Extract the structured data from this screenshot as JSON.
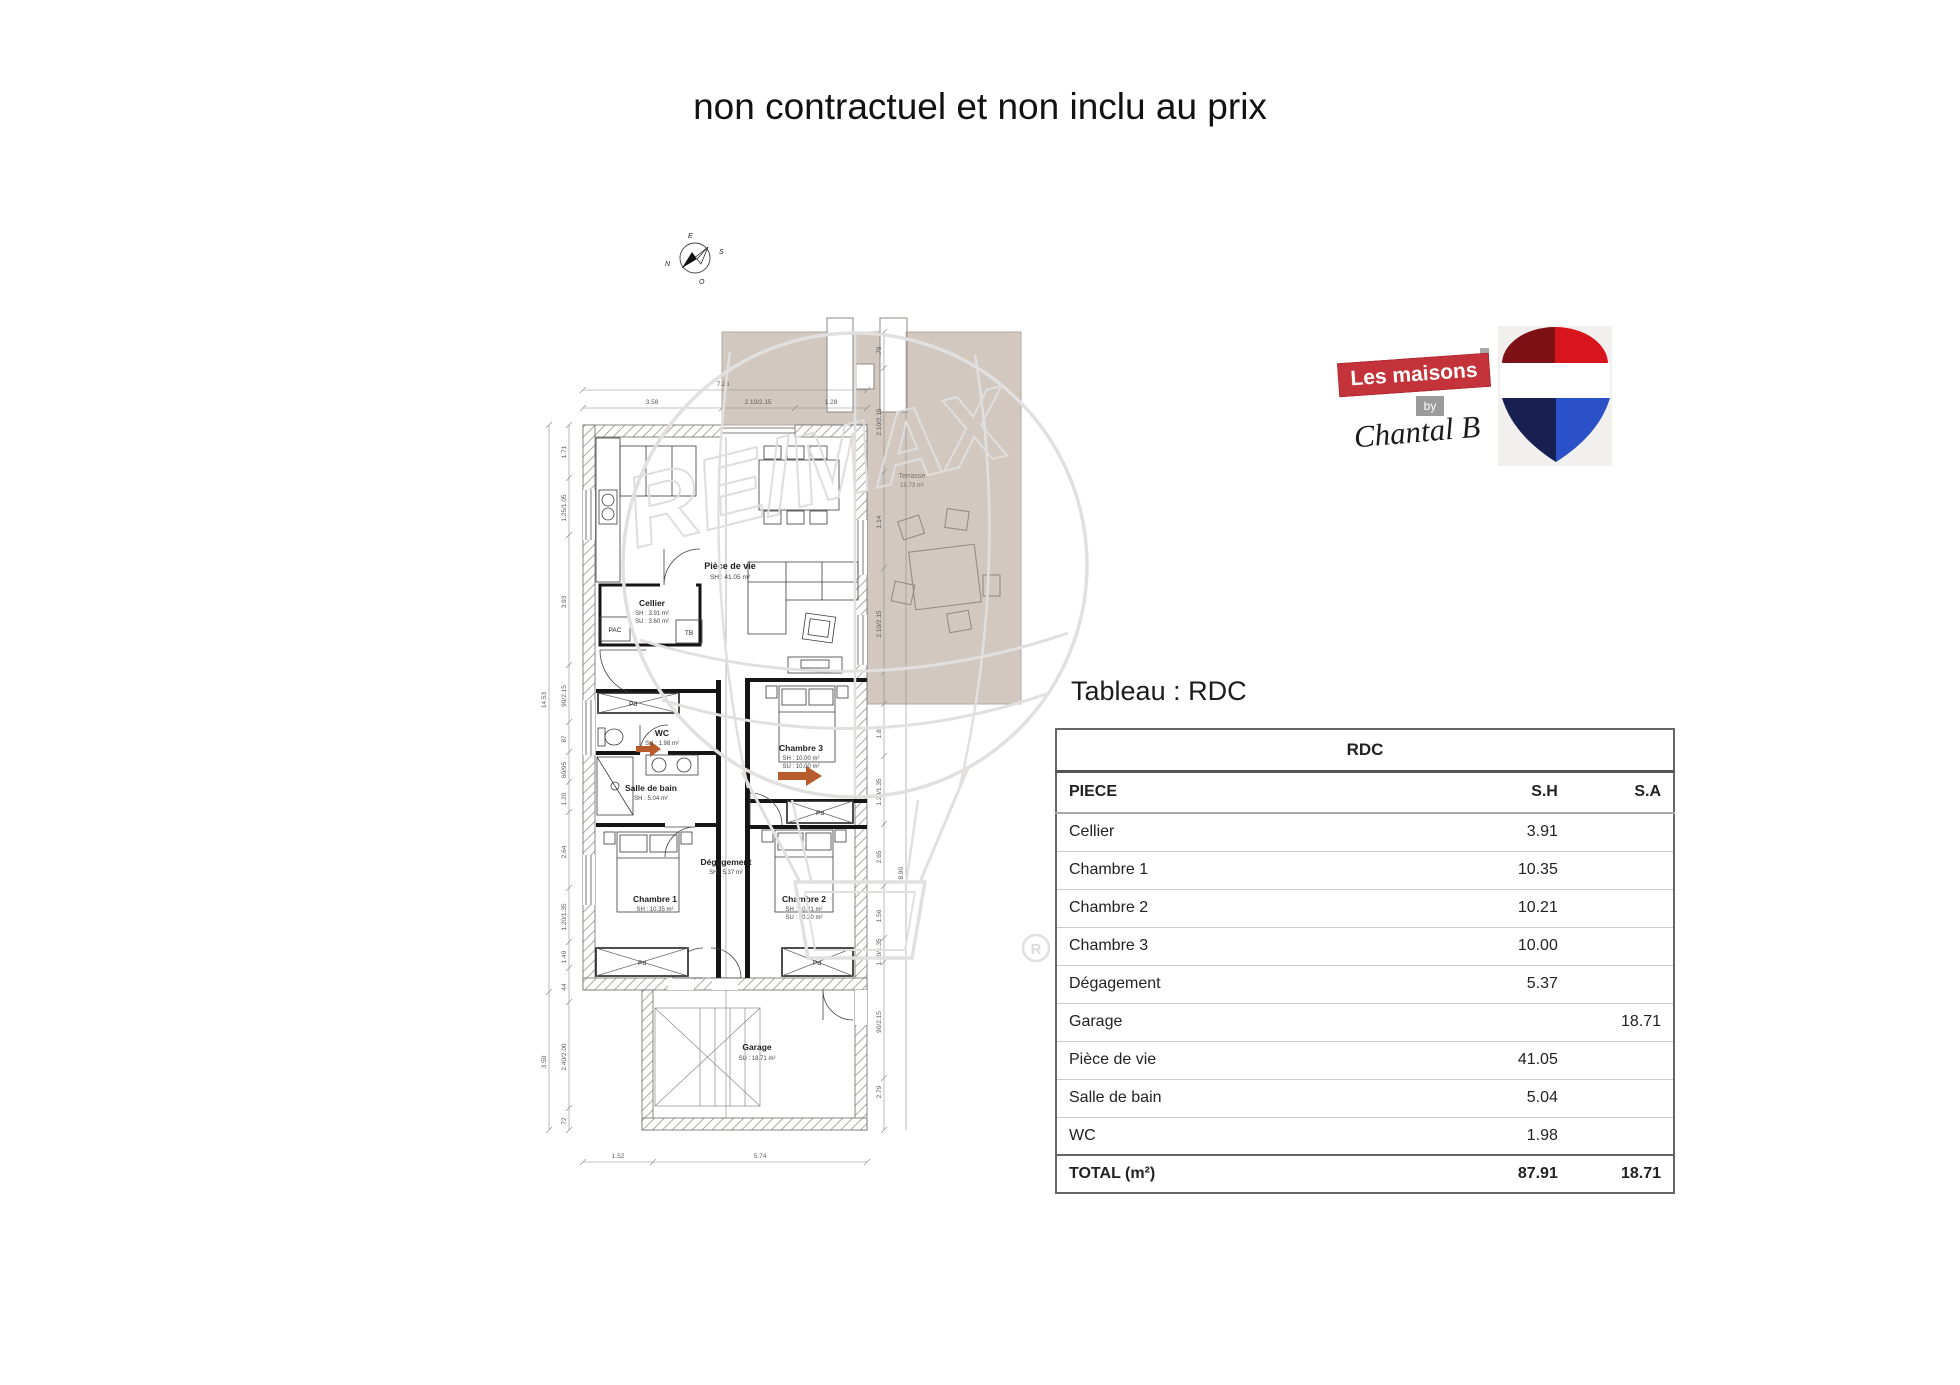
{
  "title": "non contractuel et non inclu au prix",
  "section_title": "Tableau : RDC",
  "watermark": {
    "text": "RE/MAX",
    "registered": "R"
  },
  "brand": {
    "line1": "Les maisons",
    "by": "by",
    "signature": "Chantal B"
  },
  "compass": {
    "top": "E",
    "right": "S",
    "bottom": "O",
    "left": "N"
  },
  "plan": {
    "rooms": {
      "piece_de_vie": {
        "name": "Pièce de vie",
        "sh": "SH : 41.05 m²"
      },
      "cellier": {
        "name": "Cellier",
        "sh": "SH : 3.91 m²",
        "su": "SU : 3.60 m²"
      },
      "wc": {
        "name": "WC",
        "sh": "SH : 1.98 m²"
      },
      "salle_de_bain": {
        "name": "Salle de bain",
        "sh": "SH : 5.04 m²"
      },
      "chambre1": {
        "name": "Chambre 1",
        "sh": "SH : 10.35 m²"
      },
      "chambre2": {
        "name": "Chambre 2",
        "sh": "SH : 10.21 m²",
        "su": "SU : 10.20 m²"
      },
      "chambre3": {
        "name": "Chambre 3",
        "sh": "SH : 10.00 m²",
        "su": "SU : 10.00 m²"
      },
      "degagement": {
        "name": "Dégagement",
        "sh": "SH : 5.37 m²"
      },
      "garage": {
        "name": "Garage",
        "su": "SU : 18.71 m²"
      },
      "terrasse": {
        "name": "Terrasse",
        "area": "18.73 m²"
      }
    },
    "labels": {
      "pac": "PAC",
      "tb": "TB",
      "pd": "Pd"
    },
    "dims": {
      "top_total": "7.26",
      "top": [
        "3.58",
        "2.10/2.15",
        "1.28"
      ],
      "left_total": "14.53",
      "left_lower_total": "3.50",
      "left": [
        "1.71",
        "1.25/1.05",
        "3.93",
        "90/2.15",
        "87",
        "60/95",
        "1.20",
        "2.64",
        "1.20/1.35",
        "1.49",
        "44",
        "2.40/2.00",
        "72"
      ],
      "right_terrace": [
        ".79",
        "2.10/2.15",
        "1.14",
        "2.10/2.15"
      ],
      "right": [
        "1.82",
        "1.20/1.35",
        "2.65",
        "1.56",
        "1.20/1.35",
        "90/2.15",
        "2.79"
      ],
      "right_total": "18.90",
      "bottom": [
        "1.52",
        "5.74"
      ]
    }
  },
  "table": {
    "floor_header": "RDC",
    "columns": {
      "piece": "PIECE",
      "sh": "S.H",
      "sa": "S.A"
    },
    "rows": [
      {
        "piece": "Cellier",
        "sh": "3.91",
        "sa": ""
      },
      {
        "piece": "Chambre 1",
        "sh": "10.35",
        "sa": ""
      },
      {
        "piece": "Chambre 2",
        "sh": "10.21",
        "sa": ""
      },
      {
        "piece": "Chambre 3",
        "sh": "10.00",
        "sa": ""
      },
      {
        "piece": "Dégagement",
        "sh": "5.37",
        "sa": ""
      },
      {
        "piece": "Garage",
        "sh": "",
        "sa": "18.71"
      },
      {
        "piece": "Pièce de vie",
        "sh": "41.05",
        "sa": ""
      },
      {
        "piece": "Salle de bain",
        "sh": "5.04",
        "sa": ""
      },
      {
        "piece": "WC",
        "sh": "1.98",
        "sa": ""
      }
    ],
    "total": {
      "piece": "TOTAL (m²)",
      "sh": "87.91",
      "sa": "18.71"
    }
  },
  "colors": {
    "terrace": "#d2c8c0",
    "accent_arrow": "#b75b2c",
    "brand_red": "#c5333a",
    "pin_dark_red": "#7d1116",
    "pin_red": "#d8141d",
    "pin_navy": "#182052",
    "pin_blue": "#2b51c9",
    "watermark_gray": "#e2dfdf"
  }
}
